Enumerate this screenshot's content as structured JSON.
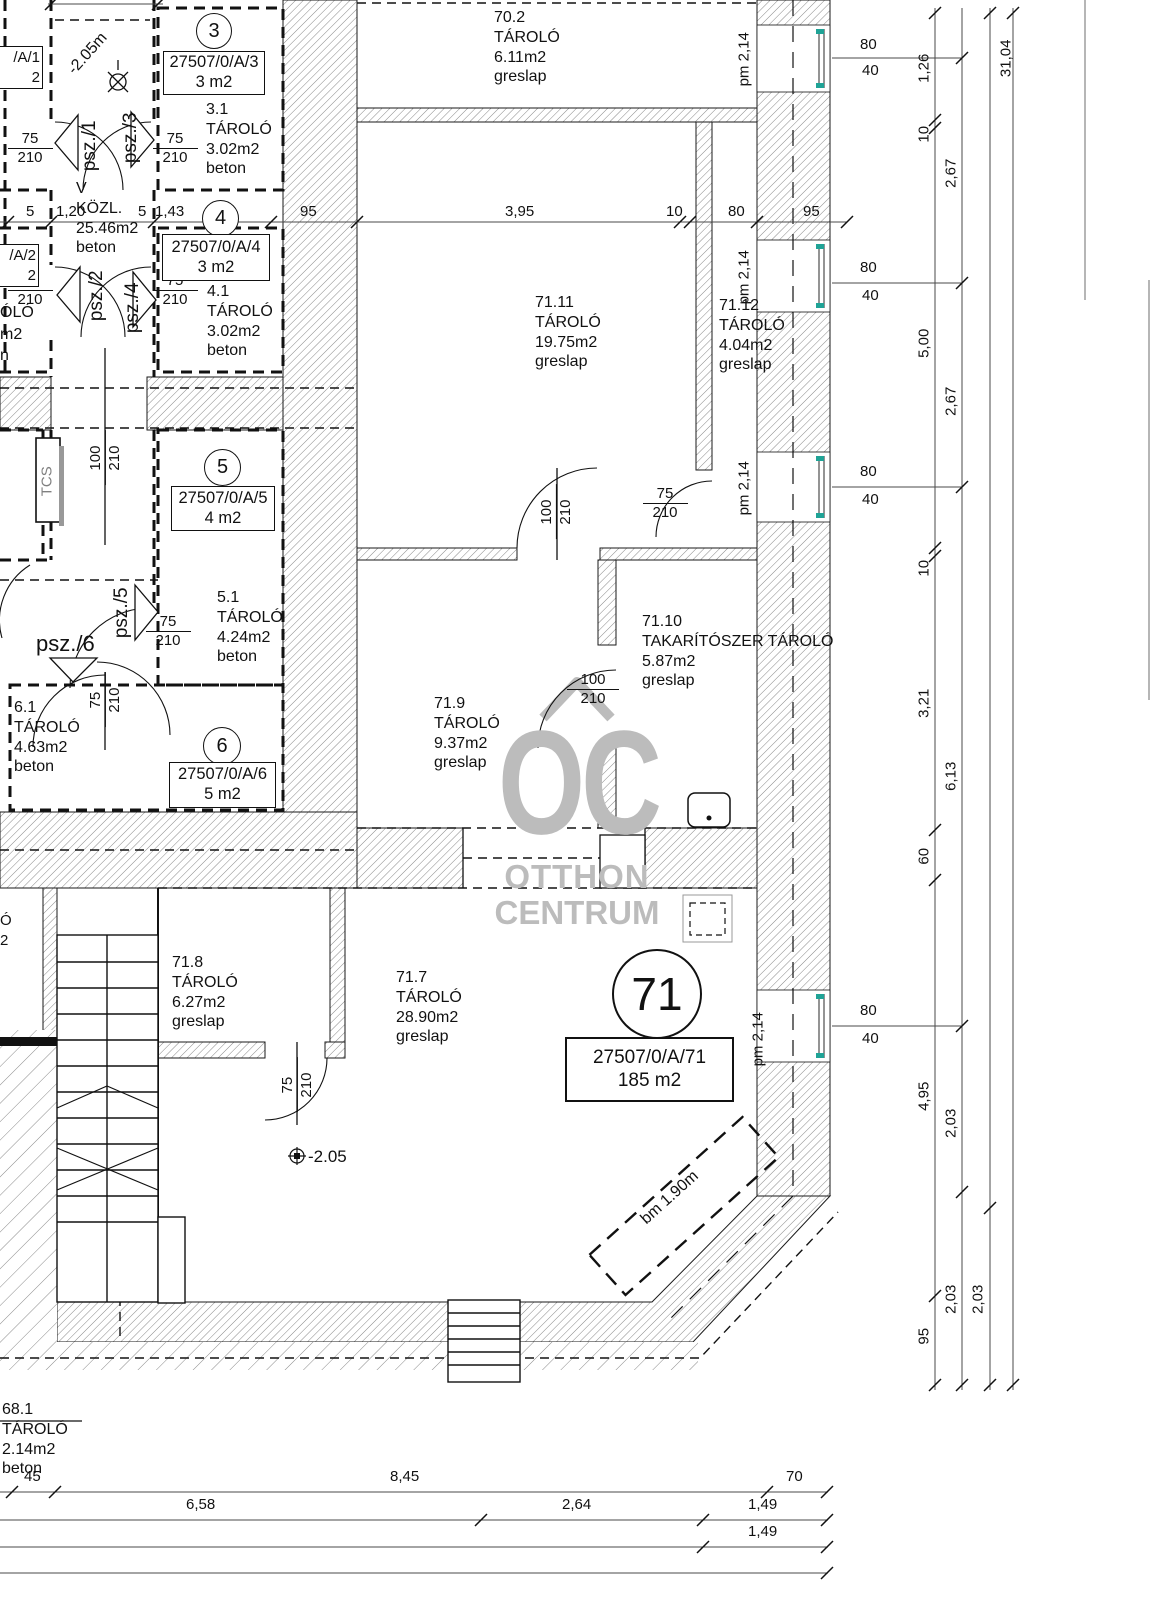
{
  "watermark": {
    "logo": "OC",
    "line1": "OTTHON",
    "line2": "CENTRUM"
  },
  "units": {
    "u3": {
      "no": "3",
      "lot": "27507/0/A/3",
      "area": "3 m2"
    },
    "u4": {
      "no": "4",
      "lot": "27507/0/A/4",
      "area": "3 m2"
    },
    "u5": {
      "no": "5",
      "lot": "27507/0/A/5",
      "area": "4 m2"
    },
    "u6": {
      "no": "6",
      "lot": "27507/0/A/6",
      "area": "5 m2"
    },
    "u71": {
      "no": "71",
      "lot": "27507/0/A/71",
      "area": "185 m2"
    },
    "u1": {
      "lot": "/A/1",
      "area": "2"
    },
    "u2": {
      "lot": "/A/2",
      "area": "2"
    }
  },
  "rooms": {
    "r702": {
      "id": "70.2",
      "name": "TÁROLÓ",
      "area": "6.11m2",
      "floor": "greslap"
    },
    "r7111": {
      "id": "71.11",
      "name": "TÁROLÓ",
      "area": "19.75m2",
      "floor": "greslap"
    },
    "r7112": {
      "id": "71.12",
      "name": "TÁROLÓ",
      "area": "4.04m2",
      "floor": "greslap"
    },
    "r719": {
      "id": "71.9",
      "name": "TÁROLÓ",
      "area": "9.37m2",
      "floor": "greslap"
    },
    "r7110": {
      "id": "71.10",
      "name": "TAKARÍTÓSZER TÁROLÓ",
      "area": "5.87m2",
      "floor": "greslap"
    },
    "r718": {
      "id": "71.8",
      "name": "TÁROLÓ",
      "area": "6.27m2",
      "floor": "greslap"
    },
    "r717": {
      "id": "71.7",
      "name": "TÁROLÓ",
      "area": "28.90m2",
      "floor": "greslap"
    },
    "r31": {
      "id": "3.1",
      "name": "TÁROLÓ",
      "area": "3.02m2",
      "floor": "beton"
    },
    "r41": {
      "id": "4.1",
      "name": "TÁROLÓ",
      "area": "3.02m2",
      "floor": "beton"
    },
    "r51": {
      "id": "5.1",
      "name": "TÁROLÓ",
      "area": "4.24m2",
      "floor": "beton"
    },
    "r61": {
      "id": "6.1",
      "name": "TÁROLÓ",
      "area": "4.63m2",
      "floor": "beton"
    },
    "kozl": {
      "id": "V",
      "name": "KÖZL.",
      "area": "25.46m2",
      "floor": "beton"
    },
    "r681": {
      "id": "68.1",
      "name": "TÁROLÓ",
      "area": "2.14m2",
      "floor": "beton"
    },
    "frag2": {
      "l1": "ÓLÓ",
      "l2": "m2",
      "l3": "n"
    },
    "fragB": {
      "l1": "Ó",
      "l2": "2"
    }
  },
  "doors": {
    "psz1": "psz./1",
    "psz2": "psz./2",
    "psz3": "psz./3",
    "psz4": "psz./4",
    "psz5": "psz./5",
    "psz6": "psz./6",
    "w75": "75",
    "w100": "100",
    "h210": "210"
  },
  "windows": {
    "pm": "pm 2,14",
    "w": "80",
    "h": "40"
  },
  "levels": {
    "top": "-2.05m",
    "main": "-2.05",
    "bm": "bm 1.90m"
  },
  "shaft": "TCS",
  "dims": {
    "top": {
      "t5a": "5",
      "t120": "1,20",
      "t5b": "5",
      "t143": "1,43",
      "t95a": "95",
      "t395": "3,95",
      "t10": "10",
      "t80": "80",
      "t95b": "95"
    },
    "right": {
      "c1": [
        "1,26",
        "10",
        "5,00",
        "10",
        "3,21",
        "60",
        "4,95",
        "95"
      ],
      "c2": [
        "2,67",
        "2,67",
        "6,13",
        "2,03",
        "2,03"
      ],
      "c3": [
        "2,03"
      ],
      "total": "31,04"
    },
    "bottom": {
      "r1": [
        "45",
        "8,45",
        "70"
      ],
      "r2": [
        "6,58",
        "2,64",
        "1,49"
      ],
      "r3": [
        "1,49"
      ]
    }
  }
}
